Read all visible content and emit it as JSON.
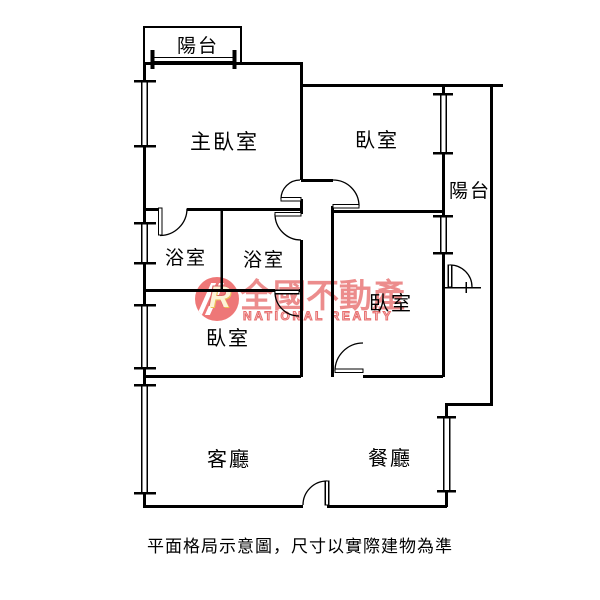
{
  "caption": "平面格局示意圖，尺寸以實際建物為準",
  "watermark": {
    "brand_cn": "全國不動產",
    "brand_en": "NATIONAL REALTY",
    "logo_letter": "R",
    "color_red": "#e04646",
    "logo_accent_yellow": "#e8b93c"
  },
  "rooms": {
    "balcony_top": {
      "label": "陽台"
    },
    "master_bedroom": {
      "label": "主臥室"
    },
    "bedroom_top_right": {
      "label": "臥室"
    },
    "balcony_right": {
      "label": "陽台"
    },
    "bathroom_left": {
      "label": "浴室"
    },
    "bathroom_right": {
      "label": "浴室"
    },
    "bedroom_mid_right": {
      "label": "臥室"
    },
    "bedroom_bottom_left": {
      "label": "臥室"
    },
    "living_room": {
      "label": "客廳"
    },
    "dining_room": {
      "label": "餐廳"
    }
  },
  "colors": {
    "wall": "#000000",
    "background": "#ffffff"
  }
}
